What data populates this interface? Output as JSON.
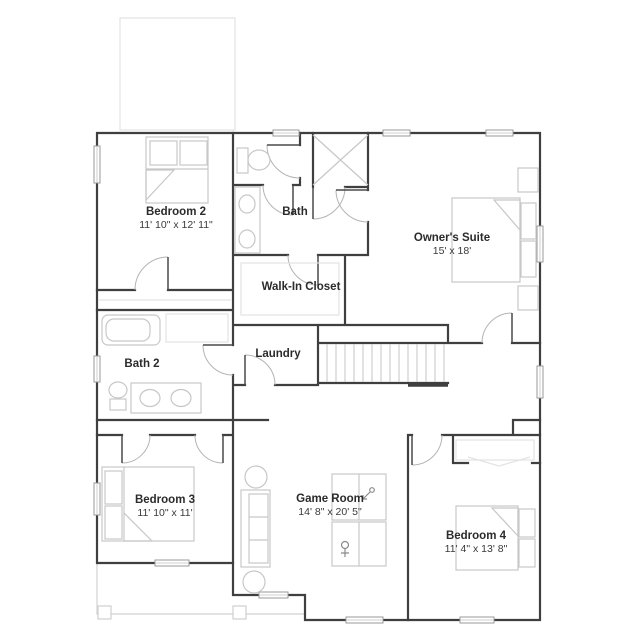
{
  "plan": {
    "type": "floor-plan",
    "rooms": [
      {
        "name": "Bedroom 2",
        "dims": "11' 10\" x 12' 11\""
      },
      {
        "name": "Bath",
        "dims": ""
      },
      {
        "name": "Owner's Suite",
        "dims": "15' x 18'"
      },
      {
        "name": "Walk-In Closet",
        "dims": ""
      },
      {
        "name": "Bath 2",
        "dims": ""
      },
      {
        "name": "Laundry",
        "dims": ""
      },
      {
        "name": "Bedroom 3",
        "dims": "11' 10\" x 11'"
      },
      {
        "name": "Game Room",
        "dims": "14' 8\" x 20' 5\""
      },
      {
        "name": "Bedroom 4",
        "dims": "11' 4\" x 13' 8\""
      }
    ],
    "fixtures": [
      "bed",
      "toilet",
      "double-vanity",
      "shower",
      "tub",
      "washer-space",
      "sofa",
      "game-tables",
      "stairs",
      "porch-posts"
    ],
    "colors": {
      "wall": "#3f3f3f",
      "furniture": "#c7c7c7",
      "door_arc": "#b4b4b4",
      "text": "#2b2b2b",
      "faint_outline": "#e3e3e3"
    }
  }
}
